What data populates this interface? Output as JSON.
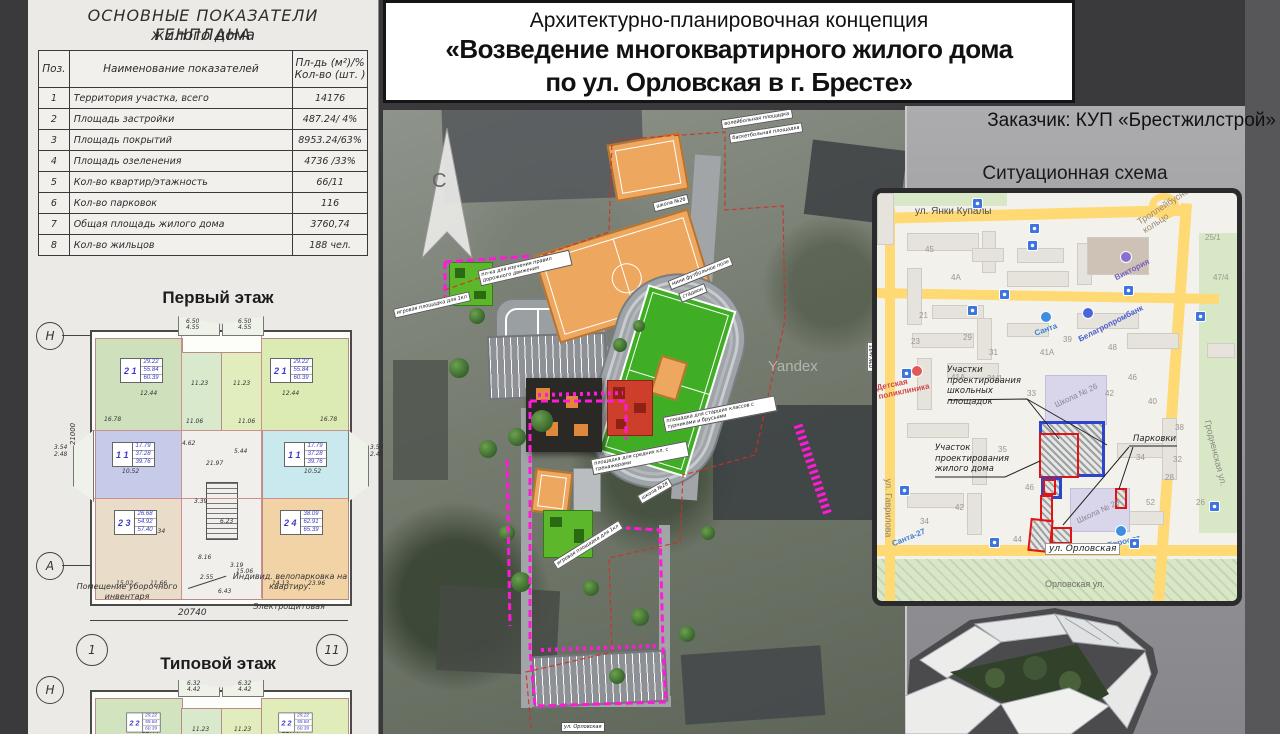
{
  "header": {
    "title_line1": "Архитектурно-планировочная концепция",
    "title_line2": "«Возведение многоквартирного жилого дома",
    "title_line3": "по ул. Орловская в г. Бресте»",
    "client": "Заказчик: КУП «Брестжилстрой»"
  },
  "indicators": {
    "title1": "ОСНОВНЫЕ ПОКАЗАТЕЛИ ГЕНПЛАНА",
    "title2": "жилого дома",
    "col_pos": "Поз.",
    "col_name": "Наименование показателей",
    "col_val1": "Пл-дь (м²)/%",
    "col_val2": "Кол-во (шт. )",
    "rows": [
      {
        "n": "1",
        "name": "Территория участка, всего",
        "val": "14176"
      },
      {
        "n": "2",
        "name": "Площадь застройки",
        "val": "487.24/ 4%"
      },
      {
        "n": "3",
        "name": "Площадь покрытий",
        "val": "8953.24/63%"
      },
      {
        "n": "4",
        "name": "Площадь озеленения",
        "val": "4736 /33%"
      },
      {
        "n": "5",
        "name": "Кол-во квартир/этажность",
        "val": "66/11"
      },
      {
        "n": "6",
        "name": "Кол-во парковок",
        "val": "116"
      },
      {
        "n": "7",
        "name": "Общая площадь жилого дома",
        "val": "3760,74"
      },
      {
        "n": "8",
        "name": "Кол-во жильцов",
        "val": "188 чел."
      }
    ]
  },
  "first_floor": {
    "heading": "Первый этаж",
    "stamps": [
      {
        "type": "2 1",
        "a": "29.22",
        "b": "55.84",
        "c": "60.39"
      },
      {
        "type": "2 1",
        "a": "29.22",
        "b": "55.84",
        "c": "60.39"
      },
      {
        "type": "1 1",
        "a": "17.79",
        "b": "37.28",
        "c": "39.76"
      },
      {
        "type": "1 1",
        "a": "17.79",
        "b": "37.28",
        "c": "39.76"
      },
      {
        "type": "2 3",
        "a": "26.68",
        "b": "54.92",
        "c": "57.40"
      },
      {
        "type": "2 4",
        "a": "38.09",
        "b": "62.91",
        "c": "65.39"
      }
    ],
    "balcony_dim1": "6.50",
    "balcony_dim2": "4.55",
    "side_dim1": "3.54",
    "side_dim2": "2.48",
    "dims": [
      "12.44",
      "11.23",
      "11.23",
      "12.44",
      "16.78",
      "16.78",
      "11.06",
      "11.06",
      "10.52",
      "10.52",
      "13.34",
      "9.92",
      "15.02",
      "11.66",
      "14.13",
      "23.96",
      "8.16",
      "15.06",
      "6.23",
      "3.39",
      "21.97",
      "5.44",
      "4.62",
      "6.43",
      "2.55",
      "3.19"
    ],
    "dim_vertical": "21000",
    "dim_bottom": "20740",
    "axis_left_top": "Н",
    "axis_left_bottom": "А",
    "axis_1": "1",
    "axis_11": "11",
    "annotations": {
      "cleaning": "Помещение уборочного инвентаря",
      "bike": "Индивид. велопарковка на квартиру.",
      "electrical": "Электрощитовая"
    }
  },
  "typical_floor": {
    "heading": "Типовой этаж",
    "axis_left": "Н",
    "balcony_dim1": "6.32",
    "balcony_dim2": "4.42",
    "dims": [
      "12.44",
      "11.23",
      "11.23",
      "12.44"
    ],
    "stamp_left": {
      "type": "2 2",
      "a": "29.22",
      "b": "55.84",
      "c": "60.39"
    },
    "stamp_right": {
      "type": "2 2",
      "a": "29.22",
      "b": "55.84",
      "c": "60.39"
    }
  },
  "site_plan": {
    "north": "С",
    "watermark": "Yandex",
    "labels": [
      "школа №26",
      "волейбольная площадка",
      "баскетбольная площадка",
      "пл-ка для изучения правил дорожного движения",
      "игровая площадка для 1кл",
      "ДЭУ №93",
      "мини футбольное поле",
      "стадион",
      "площадка для средних кл. с тренажерами",
      "площадка для старших классов с турниками и брусьями",
      "школа №28",
      "игровая площадка для 1кл",
      "ул. Орловская"
    ],
    "boundary_color": "#ff1ad6"
  },
  "situation_map": {
    "title": "Ситуационная схема",
    "streets": {
      "yanki": "ул. Янки Купалы",
      "trolleybus": "Троллейбусное кольцо",
      "grodnenskaya": "Гродненская ул.",
      "gavrilova": "ул. Гаврилова",
      "orlovskaya_box": "ул. Орловская",
      "orlovskaya_grey": "Орловская ул."
    },
    "pois": {
      "viktoria": "Виктория",
      "santa": "Санта",
      "belagro": "Белагропромбанк",
      "detpol": "Детская поликлиника",
      "santa27": "Санта-27",
      "evroopt": "Евроопт",
      "school26": "Школа № 26",
      "school28": "Школа № 28"
    },
    "callouts": {
      "schools": "Участки проектирования школьных площадок",
      "house": "Участок проектирования жилого дома",
      "parking": "Парковки"
    },
    "houses": [
      "45",
      "4А",
      "21",
      "23",
      "29",
      "31",
      "41А",
      "31/1",
      "39",
      "41А",
      "48",
      "46",
      "25/1",
      "47/4",
      "33",
      "35",
      "42",
      "40",
      "38",
      "34",
      "32",
      "28",
      "26",
      "52",
      "46",
      "42",
      "34",
      "44"
    ],
    "zone_colors": {
      "school_zone": "#2b46c8",
      "house_zone": "#e01414",
      "road": "#ffd974"
    }
  }
}
